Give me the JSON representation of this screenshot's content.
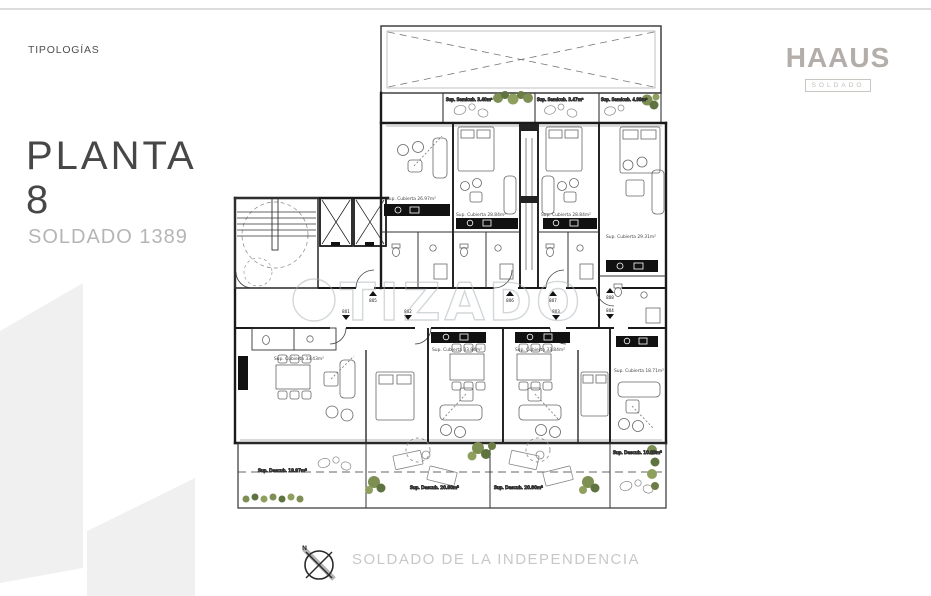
{
  "header": {
    "eyebrow": "TIPOLOGÍAS"
  },
  "title": {
    "line1": "PLANTA",
    "line2": "8",
    "subtitle": "SOLDADO 1389"
  },
  "brand": {
    "logo": "HAAUS",
    "badge": "SOLDADO"
  },
  "watermark": {
    "text": "TIZADO"
  },
  "footer": {
    "compass_north": "N",
    "street": "SOLDADO DE LA INDEPENDENCIA"
  },
  "plan": {
    "area_labels": [
      {
        "text": "Sup. Semicub. 3.40m²"
      },
      {
        "text": "Sup. Semicub. 3.47m²"
      },
      {
        "text": "Sup. Semicub. 4.99m²"
      },
      {
        "text": "Sup. Cubierta 26.97m²"
      },
      {
        "text": "Sup. Cubierta 28.84m²"
      },
      {
        "text": "Sup. Cubierta 28.84m²"
      },
      {
        "text": "Sup. Cubierta 29.31m²"
      },
      {
        "text": "Sup. Cubierta 33.43m²"
      },
      {
        "text": "Sup. Cubierta 33.84m²"
      },
      {
        "text": "Sup. Cubierta 33.84m²"
      },
      {
        "text": "Sup. Cubierta 18.71m²"
      },
      {
        "text": "Sup. Descub. 19.97m²"
      },
      {
        "text": "Sup. Descub. 20.80m²"
      },
      {
        "text": "Sup. Descub. 20.80m²"
      },
      {
        "text": "Sup. Descub. 10.03m²"
      }
    ],
    "unit_markers": [
      {
        "number": "801"
      },
      {
        "number": "802"
      },
      {
        "number": "803"
      },
      {
        "number": "804"
      },
      {
        "number": "805"
      },
      {
        "number": "806"
      },
      {
        "number": "807"
      },
      {
        "number": "808"
      }
    ]
  },
  "colors": {
    "line": "#1f1f1f",
    "plant_green": "#7d8f52",
    "plant_green_dark": "#5f7340",
    "brand_gray": "#b3aeaa",
    "muted_gray": "#b9b9b9",
    "watermark_gray": "#a9b0b5"
  }
}
